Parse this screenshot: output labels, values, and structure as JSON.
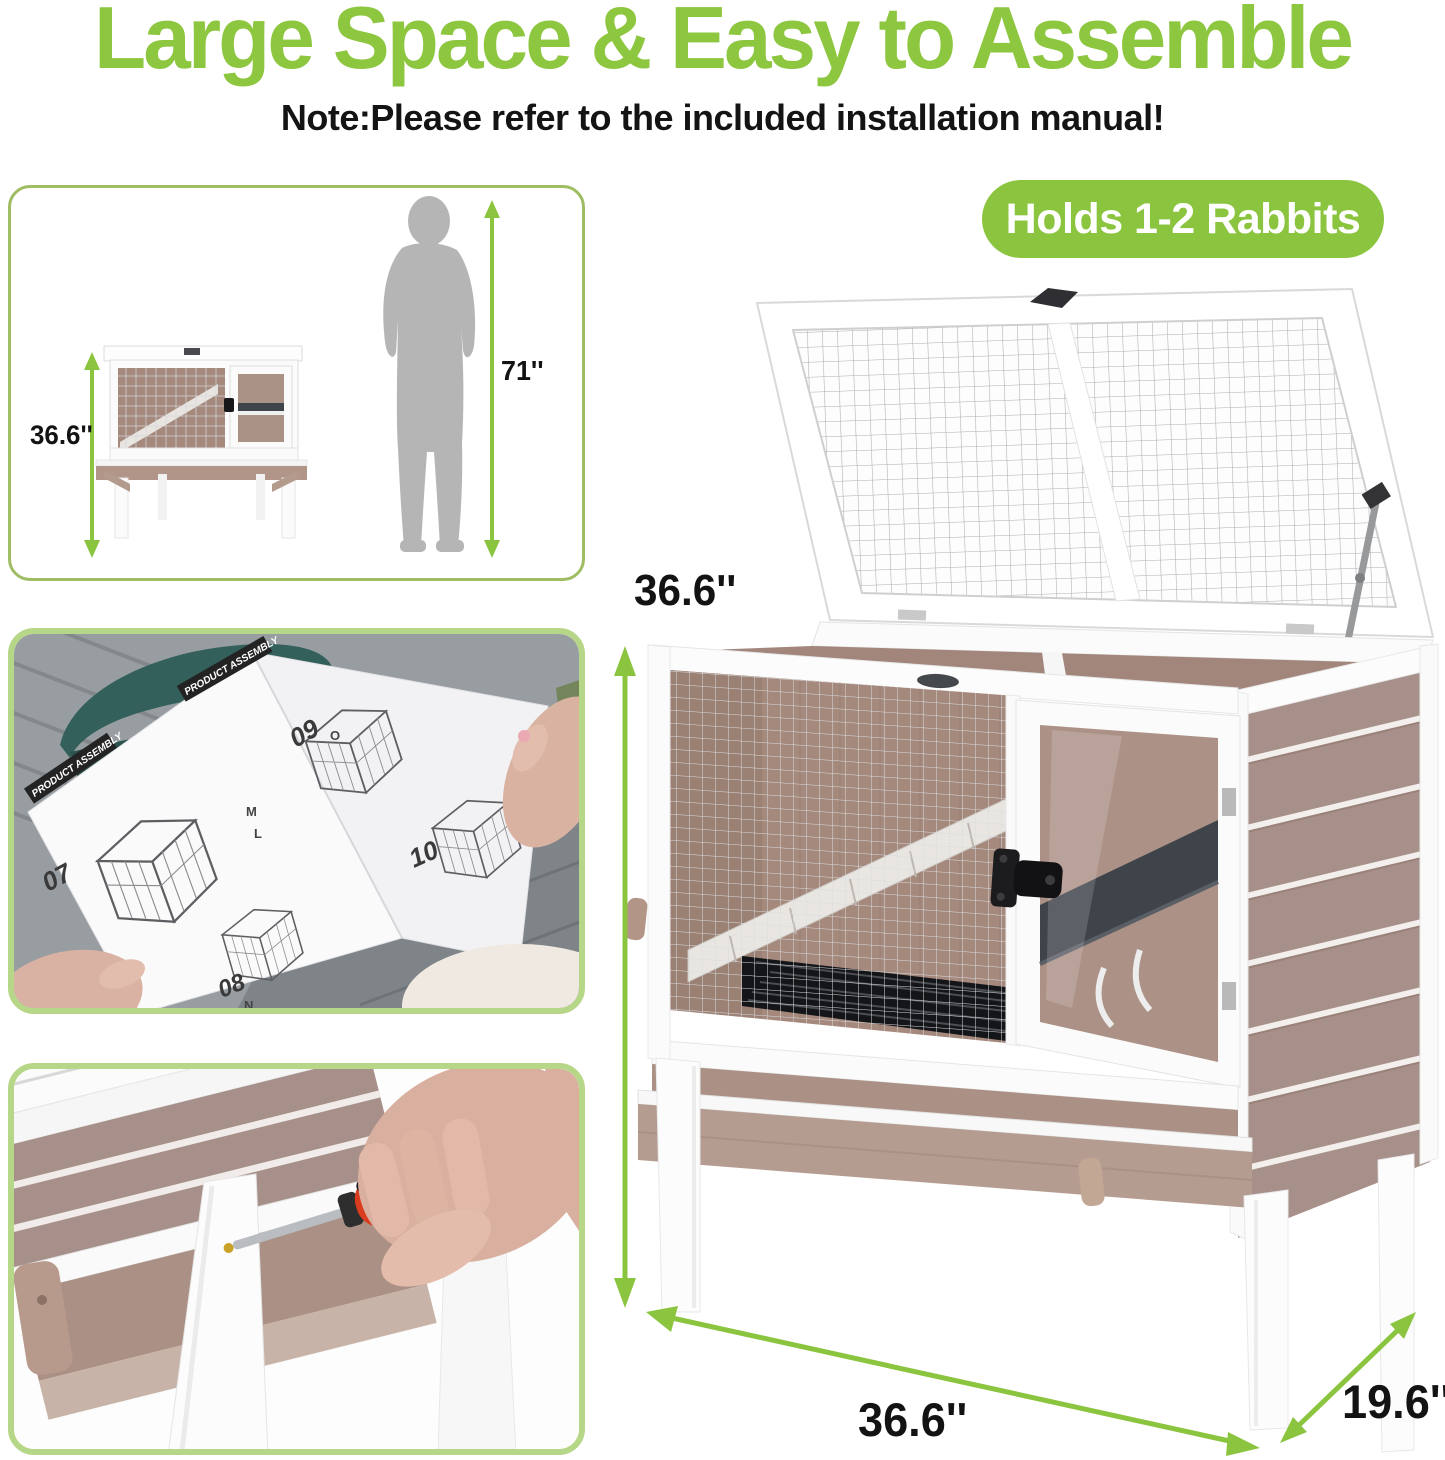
{
  "header": {
    "title": "Large Space & Easy to Assemble",
    "note": "Note:Please refer to the included installation manual!"
  },
  "badge": {
    "label": "Holds 1-2 Rabbits"
  },
  "size_comparison": {
    "hutch_height": "36.6''",
    "person_height": "71''"
  },
  "dimensions": {
    "height": "36.6''",
    "width": "36.6''",
    "depth": "19.6''"
  },
  "manual": {
    "heading_left": "PRODUCT ASSEMBLY",
    "heading_right": "PRODUCT ASSEMBLY",
    "steps": [
      "07",
      "08",
      "09",
      "10"
    ],
    "parts": [
      "M",
      "L",
      "O",
      "N"
    ]
  },
  "colors": {
    "accent_green": "#8dc63f",
    "badge_green": "#8bc540",
    "box_border_green": "#b6d688",
    "arrow_green": "#8bc53f",
    "wood_brown": "#a8908a",
    "wood_tray": "#b49b90",
    "interior_brown": "#a5897d",
    "shelf_dark": "#3f434a",
    "silhouette_gray": "#b5b5b5",
    "screwdriver_red": "#d93c1e"
  }
}
